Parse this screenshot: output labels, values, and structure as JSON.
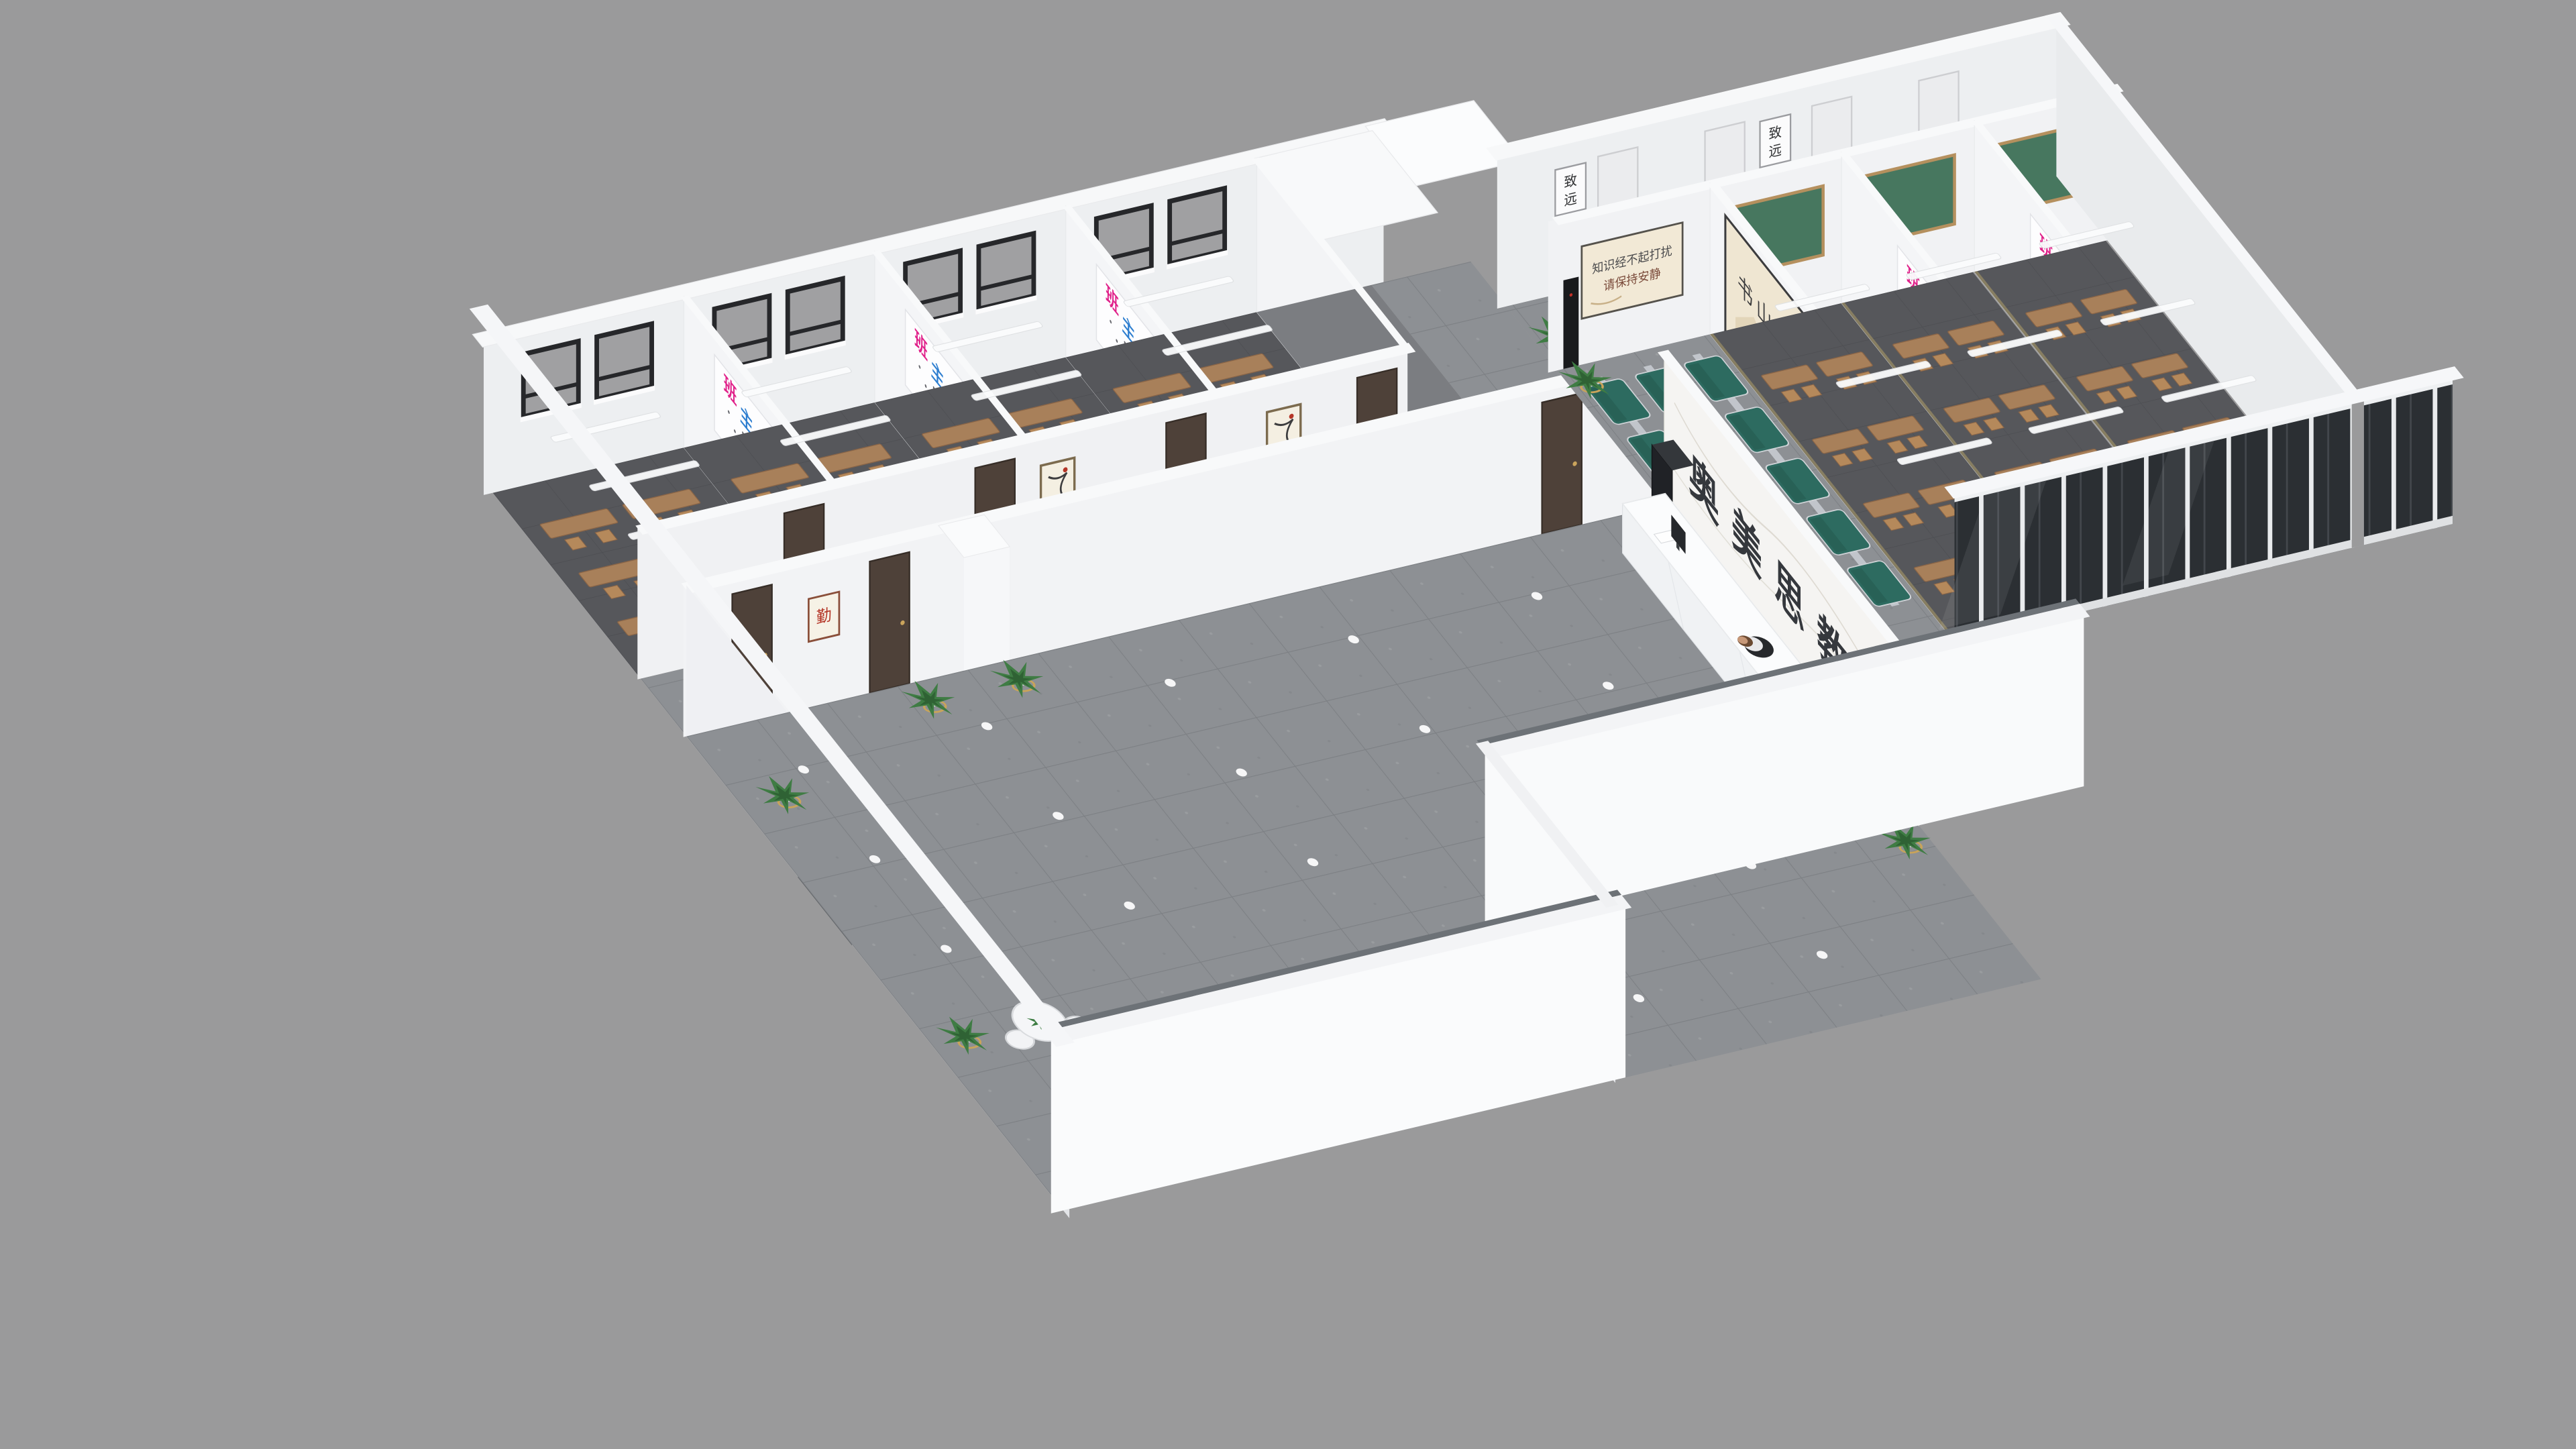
{
  "scene": {
    "type": "3d-isometric-floorplan-render",
    "subject": "Education training center interior cutaway render",
    "background_color": "#9a9a9b",
    "wall_color": "#f2f3f5",
    "wall_top_color": "#f8f9fa",
    "lobby_floor_color": "#8d9094",
    "classroom_floor_color": "#56575b"
  },
  "lobby": {
    "logo_wall": {
      "text": "奥美思教育",
      "char_color": "#35383d",
      "material": "white-marble",
      "material_color": "#f5f4f2"
    },
    "reception": {
      "desk_color": "#f0f2f4",
      "desk_top_color": "#fbfcfd",
      "staff": "receptionist-seated",
      "chair_color": "#27292c",
      "monitor_color": "#26282c"
    },
    "entrance_door_color": "#6f7478",
    "pillar_color": "#f6f7f9",
    "floor_light_color": "#ffffff",
    "waiting_area": {
      "bench_color": "#2d6b60",
      "bench_frame_color": "#c7cbd0",
      "bench_rows": 3,
      "seats_per_row": 5,
      "quiet_poster": {
        "line1": "知识经不起打扰",
        "line2": "请保持安静"
      },
      "study_poster": {
        "text": "书山有路勤为径"
      },
      "water_dispenser_color": "#191a1c"
    },
    "consult_tables": 2,
    "consult_table_color": "#f5f6f8"
  },
  "classrooms": {
    "left_wing_rooms": 4,
    "right_wing_rooms": 3,
    "teacher_poster": {
      "title": "班主任寄语",
      "chars": [
        {
          "ch": "班",
          "color": "#e0218a"
        },
        {
          "ch": "主",
          "color": "#2f7fd0"
        },
        {
          "ch": "任",
          "color": "#2ea04a"
        },
        {
          "ch": "寄",
          "color": "#d03030"
        },
        {
          "ch": "语",
          "color": "#1fb0a0"
        }
      ]
    },
    "chalkboard_color": "#47775f",
    "chalkboard_frame_color": "#b5905e",
    "desk_color": "#a8805a",
    "chair_color": "#b5895b",
    "door_color": "#4e4139",
    "window_frame_color": "#26272a",
    "light_bar_color": "#fbfcfd",
    "corridor_door_color": "#ebecee"
  },
  "corridor": {
    "calligraphy_frames": {
      "text": "致远",
      "chars": [
        "致",
        "远"
      ]
    },
    "diligence_frame": {
      "text": "勤"
    },
    "art_frame_color": "#f4efe2",
    "plant_leaf_color": "#3f7c44",
    "plant_stand_color": "#c9a45a"
  },
  "facade": {
    "glass_color": "#2b2f33",
    "mullion_color": "#e9ebed"
  }
}
